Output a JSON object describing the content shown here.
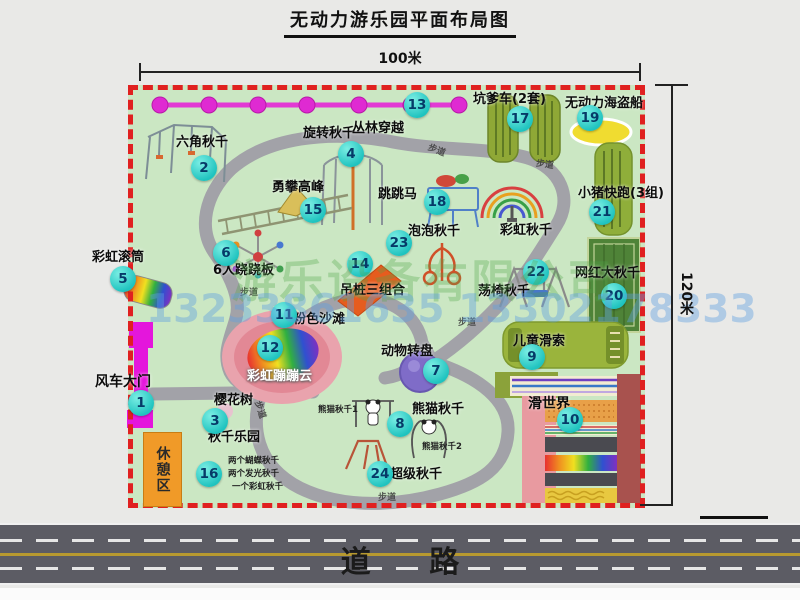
{
  "title": "无动力游乐园平面布局图",
  "dims": {
    "width_label": "100米",
    "height_label": "120米"
  },
  "road": {
    "label": "道 路"
  },
  "rest_area": {
    "label": "休憩区"
  },
  "trail_label": "步道",
  "watermark": {
    "company": "游乐设备有限公司",
    "phone": "13233861635 13302178333"
  },
  "colors": {
    "map_green": "#cbe7c3",
    "border_red": "#e02020",
    "path_gray": "#a2a2a8",
    "marker_teal": "#1fc3bf",
    "gate_magenta": "#e416dc",
    "chain_magenta": "#df2ad2",
    "rest_orange": "#f09a28",
    "beach_pink": "#e28895",
    "road_gray": "#5c5c64"
  },
  "items": {
    "gate": {
      "num": "1",
      "label": "风车大门"
    },
    "hex_swing": {
      "num": "2",
      "label": "六角秋千"
    },
    "cherry_tree": {
      "num": "3",
      "label": "樱花树"
    },
    "rotary_swing": {
      "num": "4",
      "label": "旋转秋千"
    },
    "rainbow_roller": {
      "num": "5",
      "label": "彩虹滚筒"
    },
    "seesaw6": {
      "num": "6",
      "label": "6人跷跷板"
    },
    "animal_turntable": {
      "num": "7",
      "label": "动物转盘"
    },
    "panda_swing": {
      "num": "8",
      "label": "熊猫秋千",
      "sub1": "熊猫秋千1",
      "sub2": "熊猫秋千2"
    },
    "kids_zipline": {
      "num": "9",
      "label": "儿童滑索"
    },
    "slide_world": {
      "num": "10",
      "label": "滑世界"
    },
    "pink_beach": {
      "num": "11",
      "label": "粉色沙滩"
    },
    "rainbow_cloud": {
      "num": "12",
      "label": "彩虹蹦蹦云"
    },
    "jungle_crossing": {
      "num": "13",
      "label": "丛林穿越"
    },
    "hanging_piles": {
      "num": "14",
      "label": "吊桩三组合"
    },
    "peak_climb": {
      "num": "15",
      "label": "勇攀高峰"
    },
    "swing_park": {
      "num": "16",
      "label": "秋千乐园",
      "sub1": "两个蝴蝶秋千",
      "sub2": "两个发光秋千",
      "sub3": "一个彩虹秋千"
    },
    "pit_car": {
      "num": "17",
      "label": "坑爹车(2套)"
    },
    "jump_horse": {
      "num": "18",
      "label": "跳跳马"
    },
    "pirate_ship": {
      "num": "19",
      "label": "无动力海盗船"
    },
    "big_swing": {
      "num": "20",
      "label": "网红大秋千"
    },
    "piggy_run": {
      "num": "21",
      "label": "小猪快跑(3组)"
    },
    "chair_swing": {
      "num": "22",
      "label": "荡椅秋千"
    },
    "bubble_swing": {
      "num": "23",
      "label": "泡泡秋千"
    },
    "super_swing": {
      "num": "24",
      "label": "超级秋千"
    },
    "rainbow_swing": {
      "label": "彩虹秋千"
    }
  }
}
